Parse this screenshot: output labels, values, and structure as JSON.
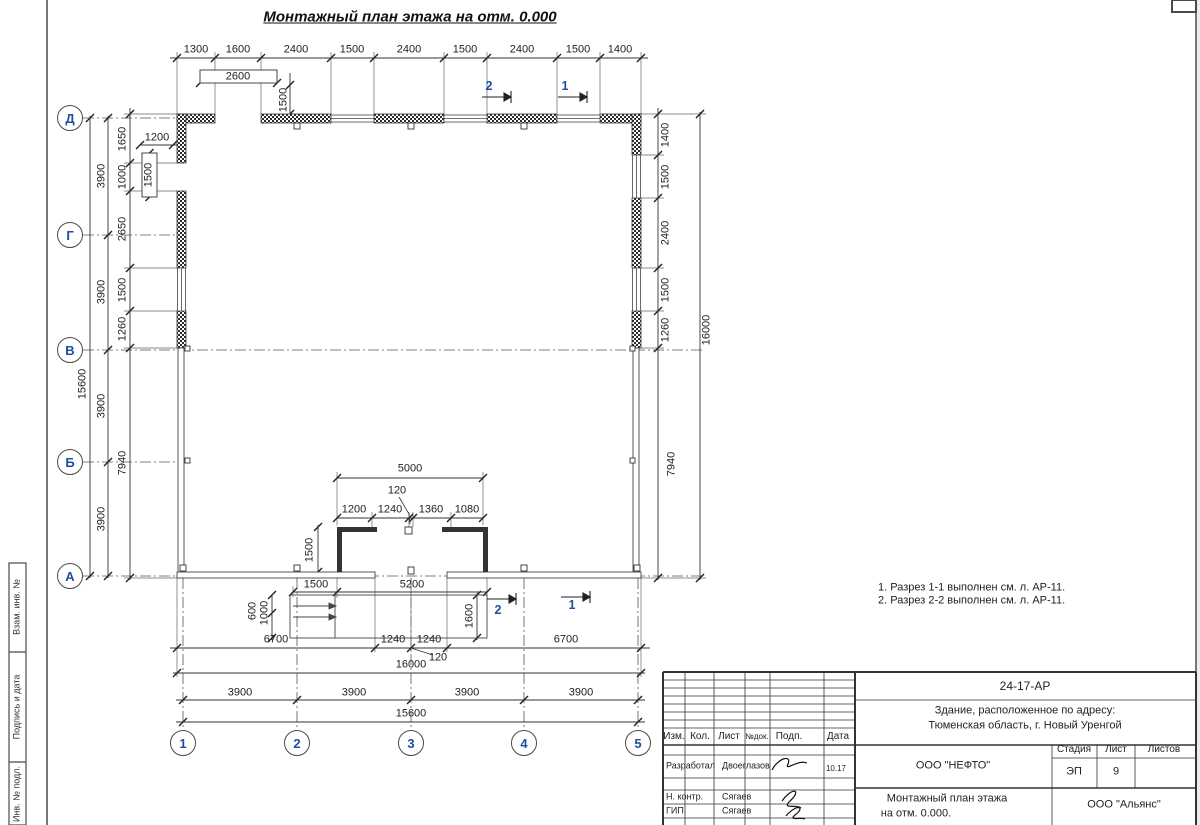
{
  "page": {
    "title": "Монтажный план этажа на отм. 0.000"
  },
  "axes": {
    "rows": [
      "Д",
      "Г",
      "В",
      "Б",
      "А"
    ],
    "cols": [
      "1",
      "2",
      "3",
      "4",
      "5"
    ]
  },
  "sections": {
    "top": [
      "2",
      "1"
    ],
    "bottom": [
      "2",
      "1"
    ]
  },
  "dims": {
    "top": [
      "1300",
      "1600",
      "2400",
      "1500",
      "2400",
      "1500",
      "2400",
      "1500",
      "1400"
    ],
    "opening_w": "2600",
    "opening_h": "1500",
    "left_total": "15600",
    "left_spacing": [
      "3900",
      "3900",
      "3900",
      "3900"
    ],
    "left_chain": [
      "1650",
      "1000",
      "2650",
      "1500",
      "1260",
      "7940"
    ],
    "win_w": "1200",
    "win_h": "1500",
    "right_chain": [
      "1400",
      "1500",
      "2400",
      "1500",
      "1260",
      "7940"
    ],
    "right_total": "16000",
    "vest_w": "5000",
    "vest_t": "120",
    "vest_chain": [
      "1200",
      "1240",
      "1360",
      "1080"
    ],
    "vest_d": "1500",
    "porch_a": "1500",
    "porch_b": "5200",
    "porch_c": "600",
    "porch_d": "1000",
    "porch_e": "1600",
    "bot_chain": [
      "6700",
      "1240",
      "1240",
      "6700"
    ],
    "bot_t": "120",
    "bot_total": "16000",
    "bot_spacing": [
      "3900",
      "3900",
      "3900",
      "3900"
    ],
    "bot_axes": "15600"
  },
  "notes": {
    "l1": "1. Разрез 1-1 выполнен см. л. АР-11.",
    "l2": "2. Разрез 2-2 выполнен см. л. АР-11."
  },
  "sidebar": {
    "c1": "Взам. инв. №",
    "c2": "Подпись и дата",
    "c3": "Инв. № подл."
  },
  "tb": {
    "doc": "24-17-АР",
    "obj1": "Здание, расположенное по адресу:",
    "obj2": "Тюменская область, г. Новый Уренгой",
    "h": [
      "Изм.",
      "Кол.",
      "Лист",
      "№док.",
      "Подп.",
      "Дата"
    ],
    "r1_role": "Разработал",
    "r1_name": "Двоеглазов",
    "r1_date": "10.17",
    "r2_role": "Н. контр.",
    "r2_name": "Сягаев",
    "r3_role": "ГИП",
    "r3_name": "Сягаев",
    "company": "ООО \"НЕФТО\"",
    "sh": [
      "Стадия",
      "Лист",
      "Листов"
    ],
    "stage": "ЭП",
    "sheet": "9",
    "t1": "Монтажный план этажа",
    "t2": "на отм. 0.000.",
    "firm": "ООО \"Альянс\""
  },
  "colors": {
    "line": "#3c3c3c",
    "axis_label": "#1f4e9c",
    "wall": "#222222"
  }
}
